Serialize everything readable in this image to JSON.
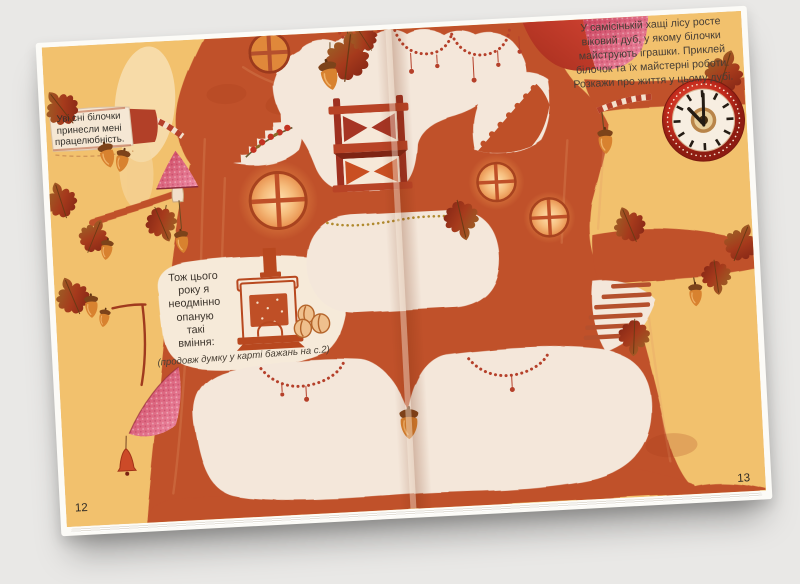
{
  "scene": {
    "background": "#e9e8e6"
  },
  "book": {
    "left_page": {
      "page_number": "12",
      "banner": {
        "lines": [
          "Уві сні білочки",
          "принесли мені",
          "працелюбність."
        ]
      },
      "thought": {
        "lines": [
          "Тож цього",
          "року я",
          "неодмінно",
          "опаную",
          "такі",
          "вміння:"
        ]
      },
      "footnote": "(продовж думку у карті бажань на с.2)"
    },
    "right_page": {
      "page_number": "13",
      "intro": {
        "lines": [
          "У самісінькій хащі лісу росте",
          "віковий дуб, у якому білочки",
          "майструють іграшки. Приклей",
          "білочок та їх майстерні роботи.",
          "Розкажи про життя у цьому дубі."
        ]
      }
    },
    "palette": {
      "page_background": "#f2c16d",
      "tree": "#c0512b",
      "room": "#f4e7da",
      "accent_red": "#b03a28",
      "pink": "#e87f9b",
      "gold": "#b08a2e"
    }
  }
}
